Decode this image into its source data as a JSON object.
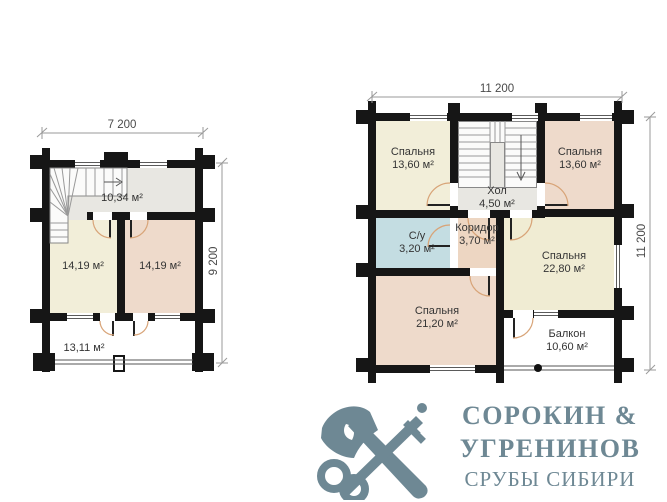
{
  "document": {
    "background": "#ffffff"
  },
  "first_floor": {
    "dim_width": "7 200",
    "dim_height": "9 200",
    "rooms": {
      "hall": {
        "area": "10,34 м²"
      },
      "bedroom_left": {
        "area": "14,19 м²"
      },
      "bedroom_right": {
        "area": "14,19 м²"
      },
      "terrace": {
        "area": "13,11 м²"
      }
    }
  },
  "second_floor": {
    "dim_width": "11 200",
    "dim_height": "11 200",
    "rooms": {
      "bedroom_top_left": {
        "name": "Спальня",
        "area": "13,60 м²"
      },
      "hall": {
        "name": "Хол",
        "area": "4,50 м²"
      },
      "bedroom_top_right": {
        "name": "Спальня",
        "area": "13,60 м²"
      },
      "bathroom": {
        "name": "С/у",
        "area": "3,20 м²"
      },
      "corridor": {
        "name": "Коридор",
        "area": "3,70 м²"
      },
      "bedroom_right": {
        "name": "Спальня",
        "area": "22,80 м²"
      },
      "bedroom_bottom_left": {
        "name": "Спальня",
        "area": "21,20 м²"
      },
      "balcony": {
        "name": "Балкон",
        "area": "10,60 м²"
      }
    }
  },
  "logo": {
    "line1": "СОРОКИН &",
    "line2": "УГРЕНИНОВ",
    "line3": "СРУБЫ СИБИРИ",
    "color": "#6e8894",
    "icon": "axe-and-key-icon"
  },
  "colors": {
    "wall": "#161616",
    "room_cream": "#f2eed9",
    "room_pink": "#eedacb",
    "room_blue": "#c4dde2",
    "room_gray": "#e8e7e2",
    "door_arc": "#d8a478"
  }
}
